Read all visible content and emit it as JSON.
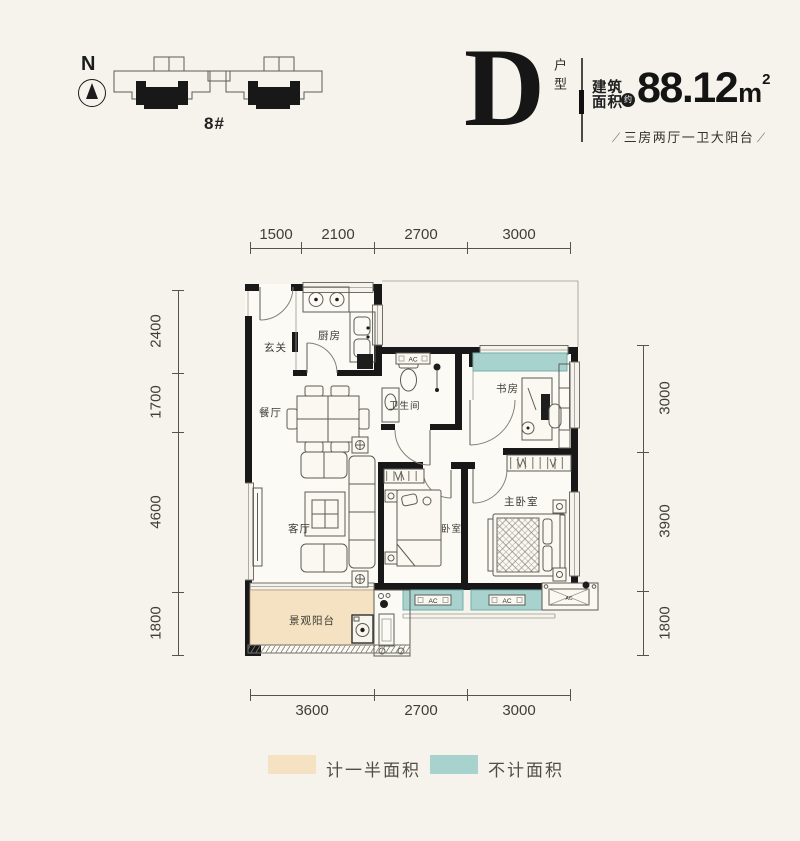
{
  "page": {
    "background": "#f5f3eb"
  },
  "header": {
    "north_label": "N",
    "building_label": "8#",
    "unit_letter": "D",
    "unit_type_label": "户型",
    "area_label": {
      "line1": "建筑",
      "line2": "面积",
      "approx": "约"
    },
    "area_value": "88.12",
    "area_unit": "m",
    "area_unit_sup": "2",
    "layout_summary": "三房两厅一卫大阳台",
    "slash": "/"
  },
  "dimensions": {
    "top": [
      "1500",
      "2100",
      "2700",
      "3000"
    ],
    "left": [
      "2400",
      "1700",
      "4600",
      "1800"
    ],
    "right": [
      "3000",
      "3900",
      "1800"
    ],
    "bottom": [
      "3600",
      "2700",
      "3000"
    ]
  },
  "rooms": {
    "entry": "玄关",
    "kitchen": "厨房",
    "dining": "餐厅",
    "bathroom": "卫生间",
    "study": "书房",
    "living": "客厅",
    "bedroom": "卧室",
    "master_bedroom": "主卧室",
    "balcony": "景观阳台"
  },
  "plan": {
    "ac_label": "AC"
  },
  "legend": {
    "half_area": {
      "label": "计一半面积",
      "color": "#f4e2c2"
    },
    "excluded_area": {
      "label": "不计面积",
      "color": "#a7d2ce"
    }
  },
  "colors": {
    "wall": "#181818",
    "teal": "#a7d2ce",
    "beige": "#f4e2c2"
  }
}
